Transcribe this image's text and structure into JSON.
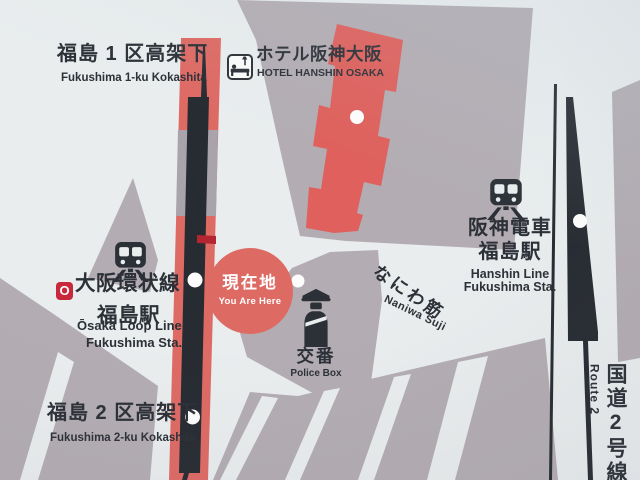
{
  "colors": {
    "bg": "#e9edee",
    "ink": "#2c3037",
    "gray": "#b3adb3",
    "gray2": "#a9a3ab",
    "band-red": "#de6a64",
    "hotel-red": "#df605c",
    "dark-red": "#b22531",
    "logo-red": "#c9283a",
    "track": "#272b32",
    "white": "#f2f5f5"
  },
  "places": {
    "fukushima1": {
      "ja": "福島 1 区高架下",
      "en": "Fukushima 1-ku Kokashita"
    },
    "hotel_hanshin": {
      "ja": "ホテル阪神大阪",
      "en": "HOTEL HANSHIN OSAKA"
    },
    "hanshin_fukushima": {
      "ja_line": "阪神電車",
      "ja_station": "福島駅",
      "en_line": "Hanshin Line",
      "en_station": "Fukushima Sta."
    },
    "loop_fukushima": {
      "logo": "O",
      "ja_line": "大阪環状線",
      "ja_station": "福島駅",
      "en_line": "Ōsaka Loop Line",
      "en_station": "Fukushima Sta."
    },
    "fukushima2": {
      "ja": "福島 2 区高架下",
      "en": "Fukushima 2-ku Kokashita"
    },
    "you_are_here": {
      "ja": "現在地",
      "en": "You Are Here"
    },
    "police_box": {
      "ja": "交番",
      "en": "Police Box"
    },
    "naniwa_suji": {
      "ja": "なにわ筋",
      "en": "Naniwa Suji"
    },
    "route2": {
      "ja": "国道2号線",
      "en": "Route 2"
    }
  }
}
